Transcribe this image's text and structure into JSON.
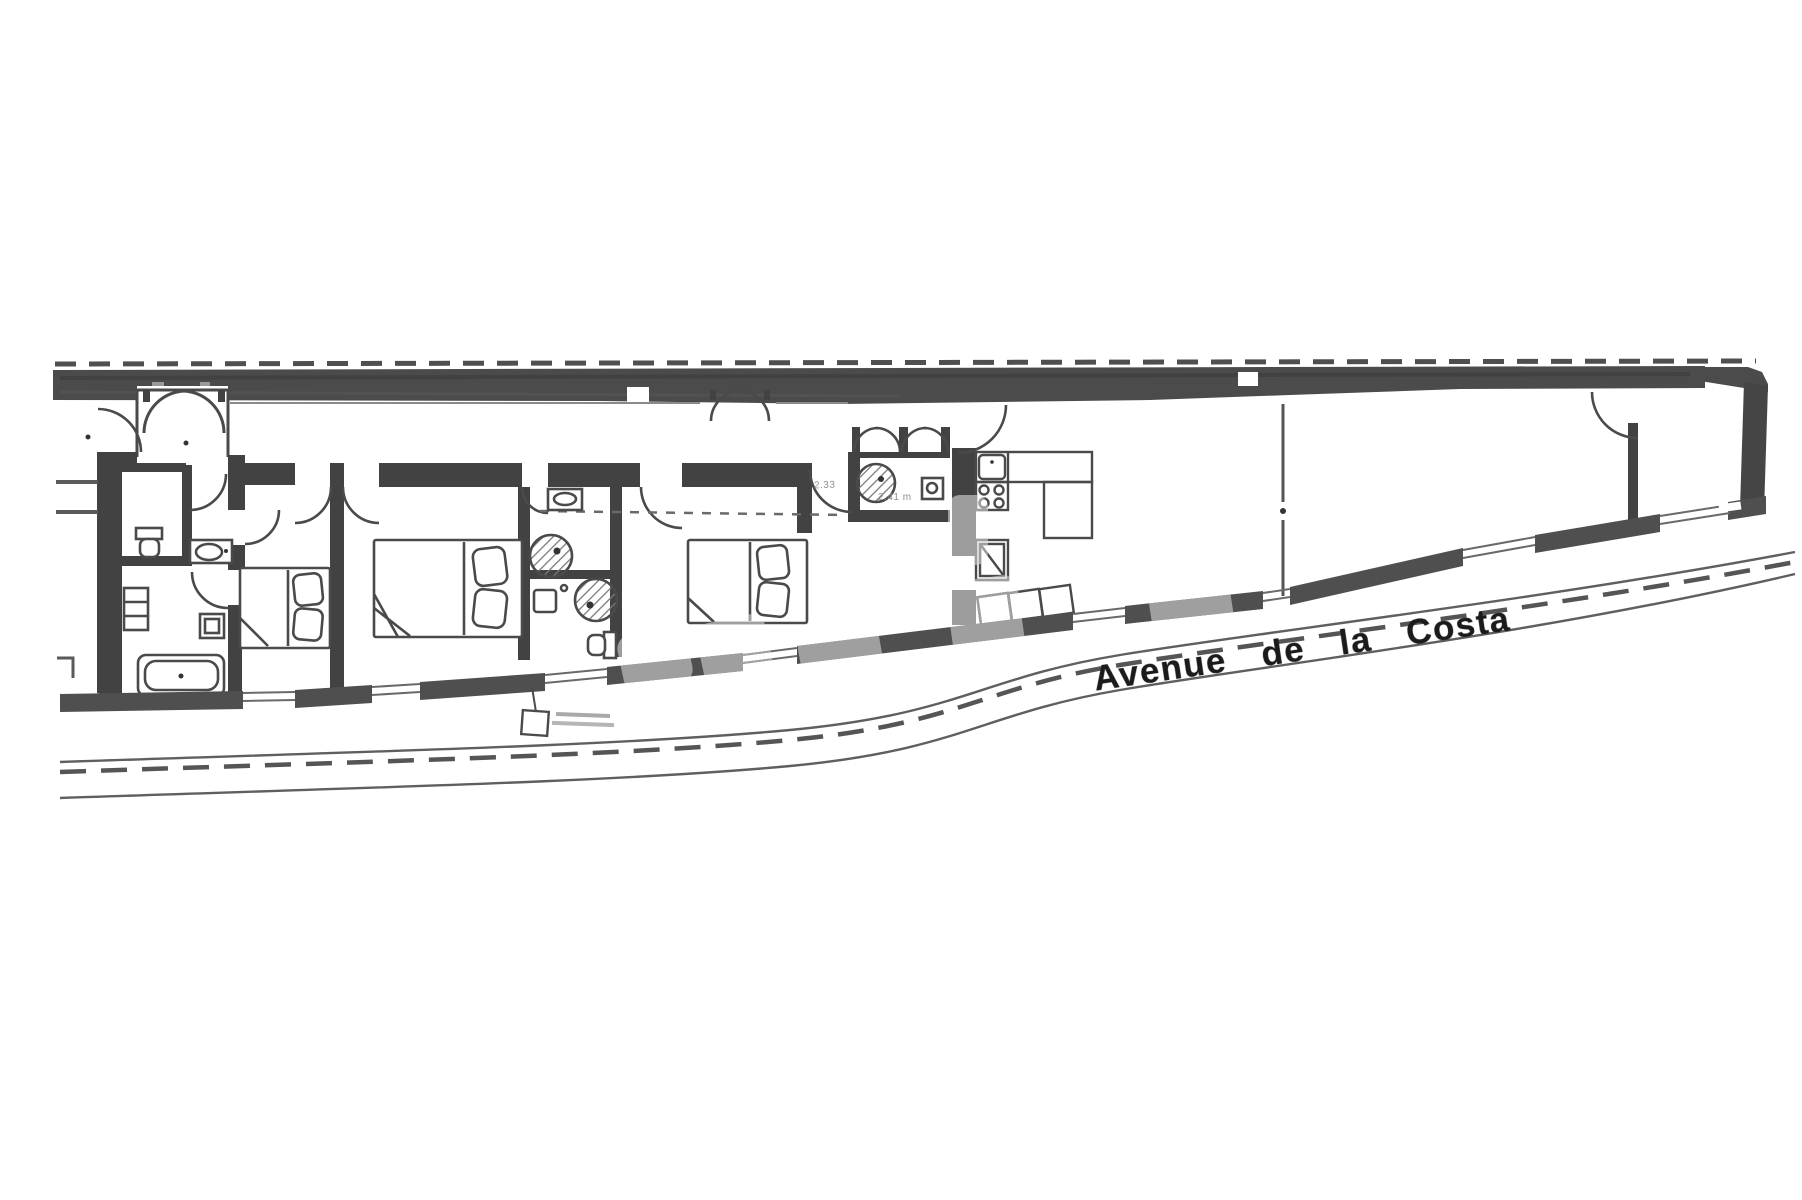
{
  "street_label": {
    "text": "Avenue de la Costa"
  },
  "annotations": {
    "dim_small_1": "2.33",
    "dim_small_2": "2.41 m"
  },
  "colors": {
    "paper": "#ffffff",
    "wall_dark": "#424242",
    "boundary_band": "#4b4b4b",
    "thin_line": "#4a4a4a",
    "street_line": "#5f5f5f",
    "text_dark": "#1b1b1b",
    "faint_text": "#8d8d8d"
  },
  "plan": {
    "type": "apartment-floor-plan",
    "rooms": [
      "entrance-porch",
      "hallway",
      "wc",
      "bathroom",
      "bedroom-1",
      "bedroom-2",
      "shower-room-1",
      "shower-room-2",
      "bedroom-3",
      "wc-shower",
      "kitchen",
      "living-room",
      "end-room"
    ],
    "fixtures": [
      "double-bed-1",
      "double-bed-2",
      "double-bed-3",
      "bathtub",
      "toilet-1",
      "toilet-2",
      "washbasin-hall",
      "washbasin-shower-1",
      "washbasin-wc",
      "kitchen-sink",
      "stove-4-burners",
      "kitchen-island",
      "fridge",
      "shower-circle-1",
      "shower-circle-2",
      "shower-circle-3"
    ],
    "street": "avenue-with-dashed-centerline"
  }
}
